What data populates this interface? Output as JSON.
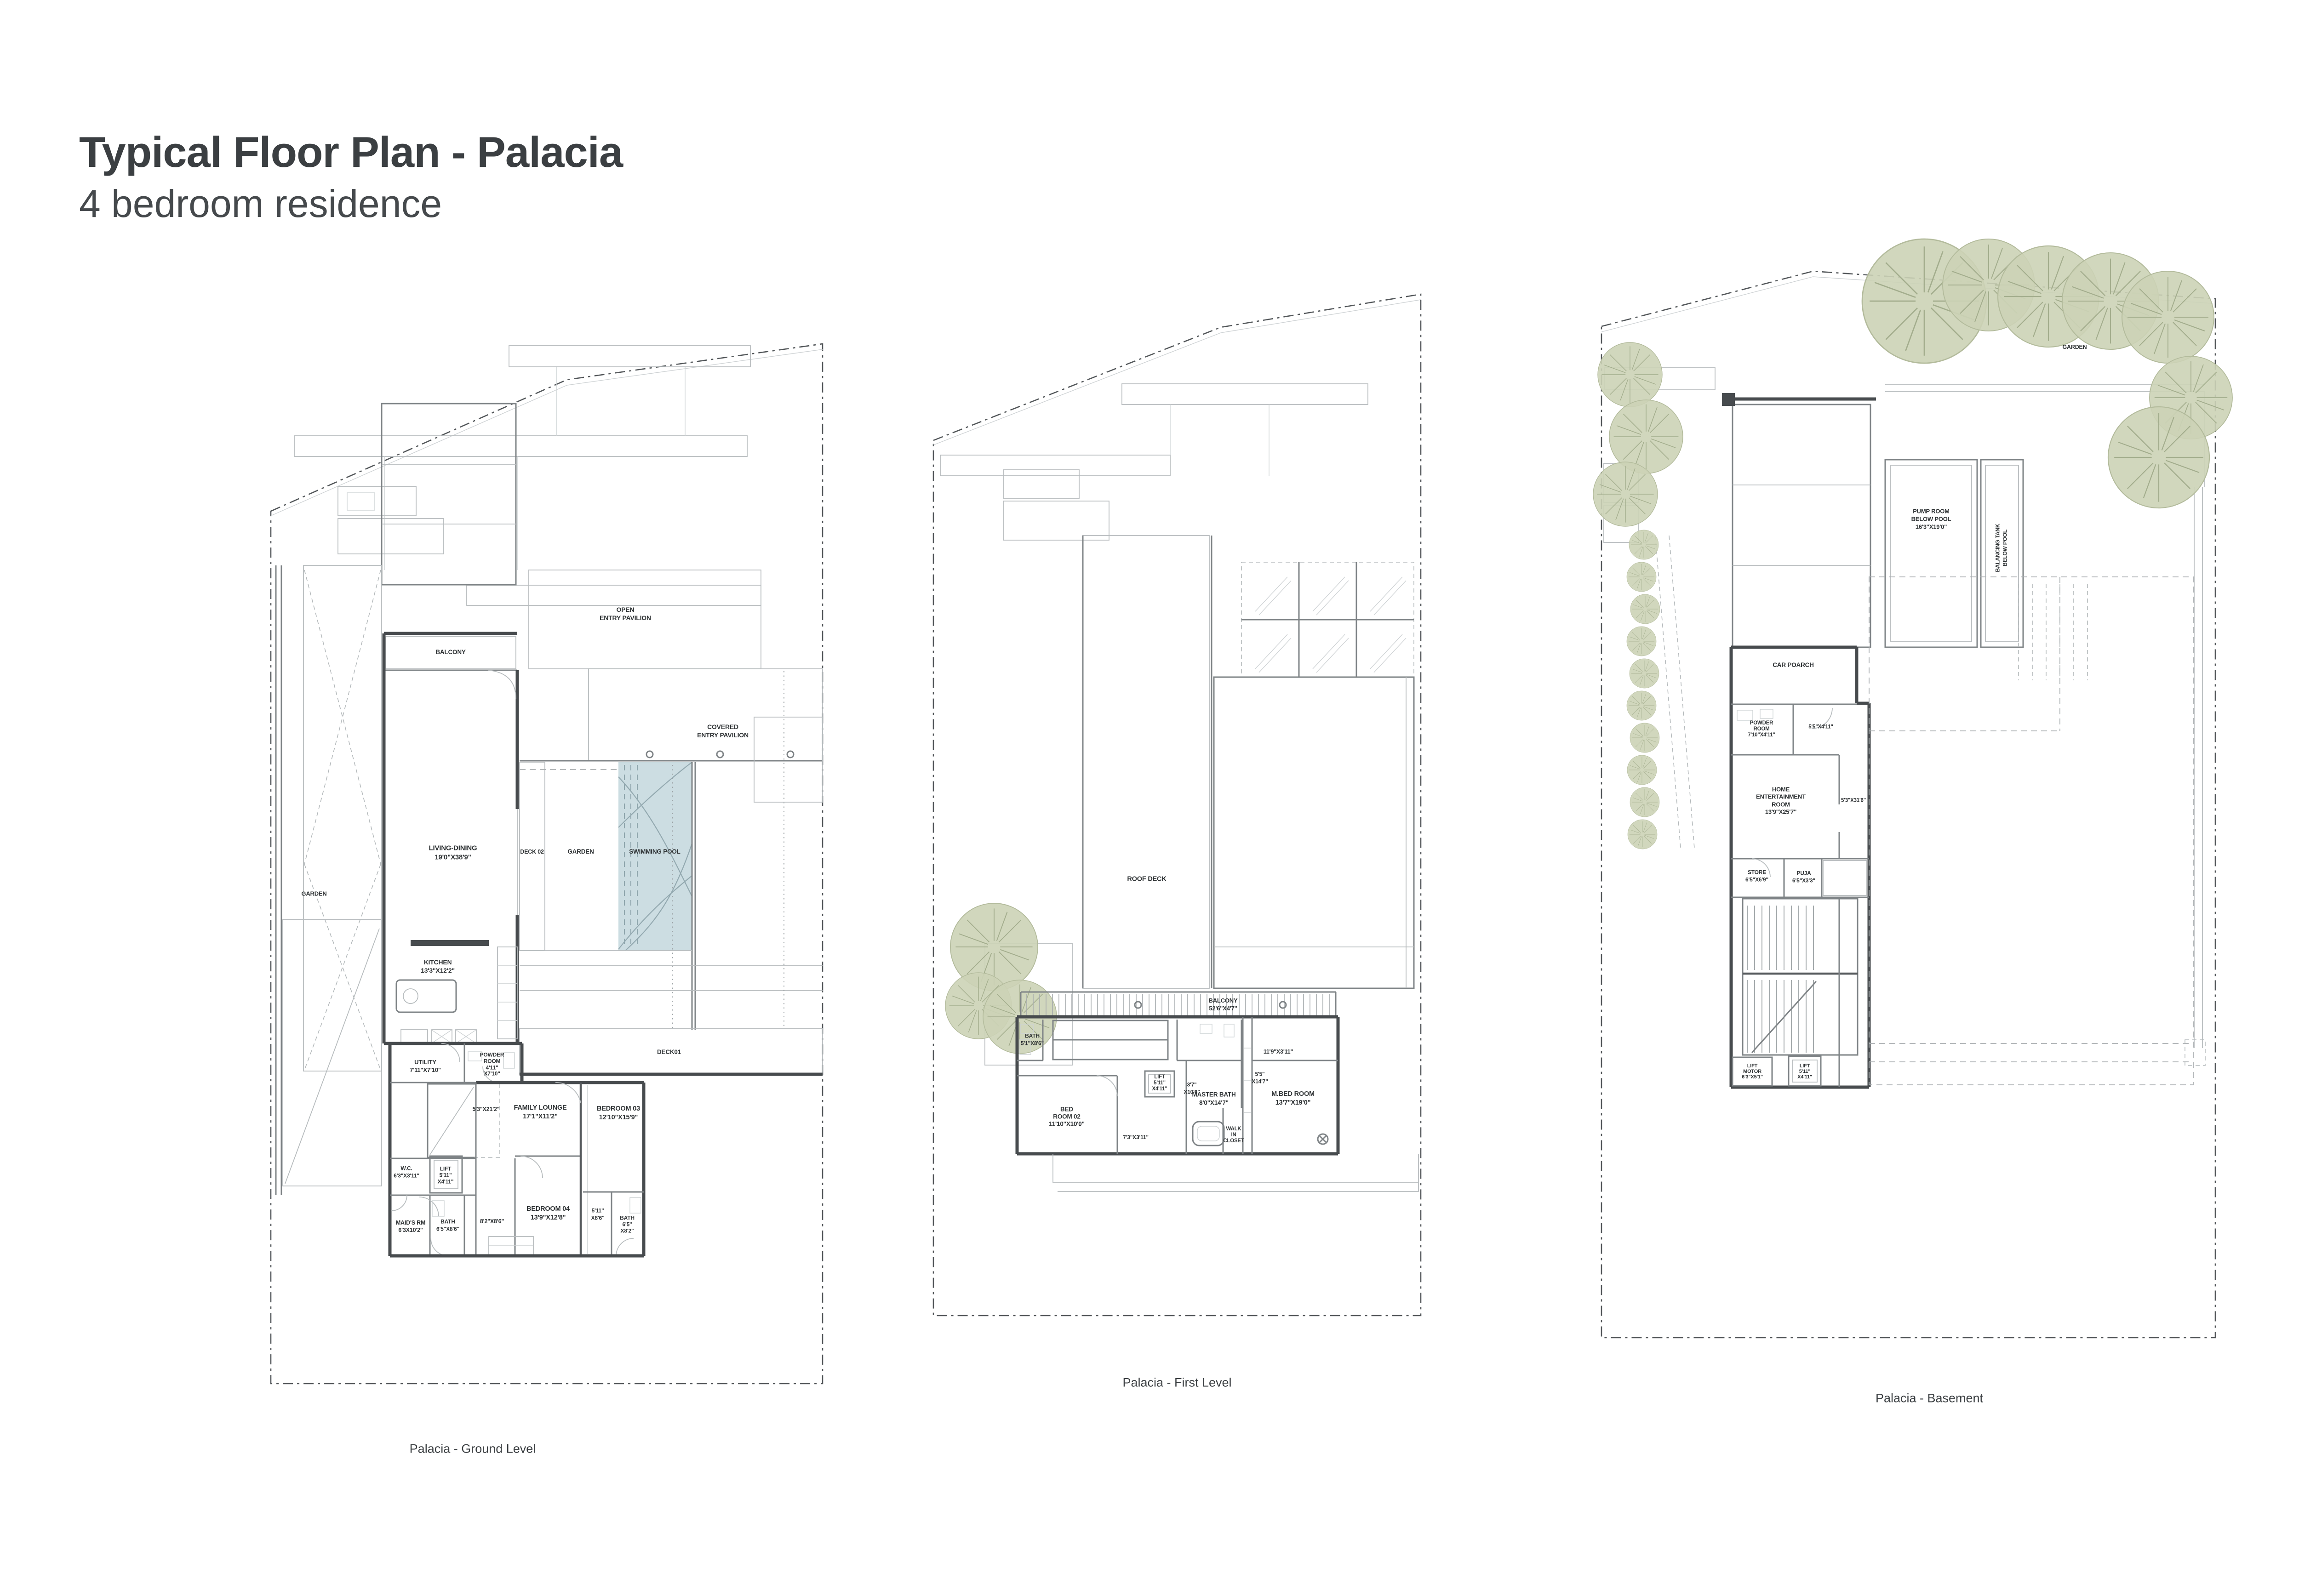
{
  "title": {
    "line1": "Typical Floor Plan - Palacia",
    "line2": "4 bedroom residence"
  },
  "colors": {
    "pool": "#ccdde2",
    "tree": "#ccd3b6",
    "wall": "#474b4e",
    "line_light": "#b7bcbe",
    "text": "#2e3234"
  },
  "ground": {
    "caption": "Palacia - Ground Level",
    "labels": {
      "garden_left": "GARDEN",
      "open_pavilion": "OPEN\nENTRY PAVILION",
      "covered_pavilion": "COVERED\nENTRY PAVILION",
      "balcony": "BALCONY",
      "living_dining": "LIVING-DINING\n19'0\"X38'9\"",
      "deck02": "DECK 02",
      "garden_center": "GARDEN",
      "swimming_pool": "SWIMMING POOL",
      "kitchen": "KITCHEN\n13'3\"X12'2\"",
      "utility": "UTILITY\n7'11\"X7'10\"",
      "powder_room": "POWDER\nROOM\n4'11\"\nX7'10\"",
      "deck01": "DECK01",
      "corridor_5_3": "5'3\"X21'2\"",
      "family_lounge": "FAMILY LOUNGE\n17'1\"X11'2\"",
      "bedroom03": "BEDROOM 03\n12'10\"X15'9\"",
      "wc": "W.C.\n6'3\"X3'11\"",
      "lift": "LIFT\n5'11\"\nX4'11\"",
      "maids_rm": "MAID'S RM\n6'3X10'2\"",
      "bath_left": "BATH\n6'5\"X8'6\"",
      "passage_8_2": "8'2\"X8'6\"",
      "bedroom04": "BEDROOM 04\n13'9\"X12'8\"",
      "corridor_5_11": "5'11\"\nX8'6\"",
      "bath_right": "BATH\n6'5\"\nX8'2\""
    }
  },
  "first": {
    "caption": "Palacia - First Level",
    "labels": {
      "roof_deck": "ROOF DECK",
      "balcony": "BALCONY\n52'6\"X4'7\"",
      "bath": "BATH\n5'1\"X8'6\"",
      "corridor_11_9": "11'9\"X3'11\"",
      "bedroom02": "BED\nROOM 02\n11'10\"X10'0\"",
      "lift": "LIFT\n5'11\"\nX4'11\"",
      "corridor_3_7": "3'7\"\nX10'6\"",
      "master_bath": "MASTER BATH\n8'0\"X14'7\"",
      "corridor_5_5": "5'5\"\nX14'7\"",
      "m_bedroom": "M.BED ROOM\n13'7\"X19'0\"",
      "corridor_7_3": "7'3\"X3'11\"",
      "walk_in_closet": "WALK\nIN\nCLOSET"
    }
  },
  "basement": {
    "caption": "Palacia - Basement",
    "labels": {
      "garden": "GARDEN",
      "pump_room": "PUMP ROOM\nBELOW POOL\n16'3\"X19'0\"",
      "balancing_tank": "BALANCING TANK\nBELOW POOL",
      "car_porch": "CAR POARCH",
      "powder_room": "POWDER\nROOM\n7'10\"X4'11\"",
      "corridor_5_5": "5'5\"X4'11\"",
      "home_entertainment": "HOME\nENTERTAINMENT\nROOM\n13'9\"X25'7\"",
      "corridor_5_3": "5'3\"X31'6\"",
      "store": "STORE\n6'5\"X6'9\"",
      "puja": "PUJA\n6'5\"X3'3\"",
      "lift_motor": "LIFT\nMOTOR\n6'3\"X5'1\"",
      "lift": "LIFT\n5'11\"\nX4'11\""
    }
  }
}
